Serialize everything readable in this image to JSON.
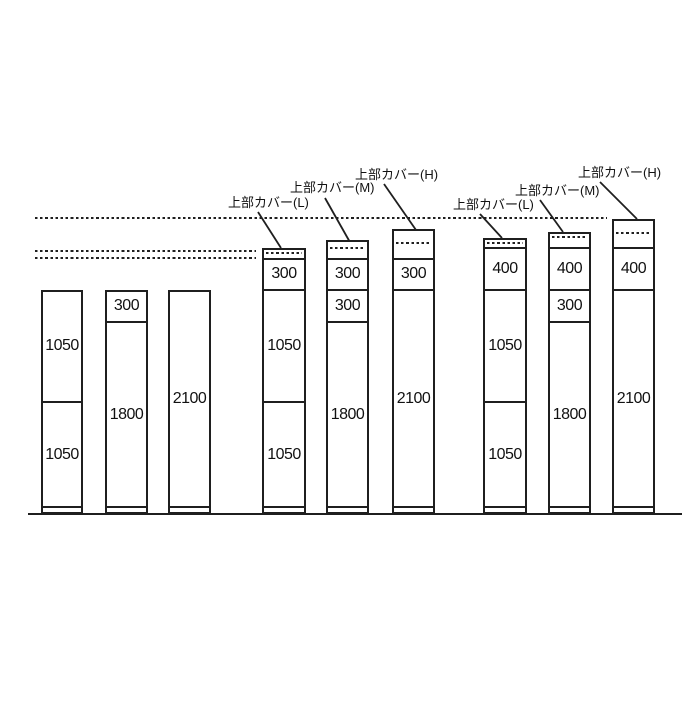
{
  "diagram": {
    "background": "#ffffff",
    "line_color": "#1f1f1f",
    "baseline": {
      "y": 514,
      "x1": 28,
      "x2": 682
    },
    "plinth_offset": 7,
    "guide_lines": [
      {
        "name": "ceiling-guide-line",
        "y": 218,
        "x1": 35,
        "x2": 607
      },
      {
        "name": "upper-ref-guide-line",
        "y": 251,
        "x1": 35,
        "x2": 256
      },
      {
        "name": "lower-ref-guide-line",
        "y": 258,
        "x1": 35,
        "x2": 256
      }
    ],
    "cover_labels": [
      {
        "text": "上部カバー(L)",
        "x": 228,
        "y": 195,
        "leader": [
          258,
          212,
          281,
          248
        ]
      },
      {
        "text": "上部カバー(M)",
        "x": 290,
        "y": 180,
        "leader": [
          325,
          198,
          351,
          244
        ]
      },
      {
        "text": "上部カバー(H)",
        "x": 355,
        "y": 167,
        "leader": [
          384,
          184,
          416,
          230
        ]
      },
      {
        "text": "上部カバー(L)",
        "x": 453,
        "y": 197,
        "leader": [
          480,
          214,
          502,
          238
        ]
      },
      {
        "text": "上部カバー(M)",
        "x": 515,
        "y": 183,
        "leader": [
          540,
          200,
          563,
          232
        ]
      },
      {
        "text": "上部カバー(H)",
        "x": 578,
        "y": 165,
        "leader": [
          600,
          182,
          637,
          219
        ]
      }
    ],
    "bars": [
      {
        "x": 41,
        "w": 42,
        "segments": [
          {
            "value": "1050",
            "h": 112
          },
          {
            "value": "1050",
            "h": 112
          }
        ]
      },
      {
        "x": 105,
        "w": 43,
        "segments": [
          {
            "value": "300",
            "h": 32
          },
          {
            "value": "1800",
            "h": 192
          }
        ]
      },
      {
        "x": 168,
        "w": 43,
        "segments": [
          {
            "value": "2100",
            "h": 224
          }
        ]
      },
      {
        "x": 262,
        "w": 44,
        "cover": {
          "type": "L",
          "h": 10,
          "dash": 5
        },
        "segments": [
          {
            "value": "300",
            "h": 32
          },
          {
            "value": "1050",
            "h": 112
          },
          {
            "value": "1050",
            "h": 112
          }
        ]
      },
      {
        "x": 326,
        "w": 43,
        "cover": {
          "type": "M",
          "h": 18,
          "dash": 8
        },
        "segments": [
          {
            "value": "300",
            "h": 32
          },
          {
            "value": "300",
            "h": 32
          },
          {
            "value": "1800",
            "h": 192
          }
        ]
      },
      {
        "x": 392,
        "w": 43,
        "cover": {
          "type": "H",
          "h": 29,
          "dash": 14
        },
        "segments": [
          {
            "value": "300",
            "h": 32
          },
          {
            "value": "2100",
            "h": 224
          }
        ]
      },
      {
        "x": 483,
        "w": 44,
        "cover": {
          "type": "L",
          "h": 9,
          "dash": 5
        },
        "segments": [
          {
            "value": "400",
            "h": 43
          },
          {
            "value": "1050",
            "h": 112
          },
          {
            "value": "1050",
            "h": 112
          }
        ]
      },
      {
        "x": 548,
        "w": 43,
        "cover": {
          "type": "M",
          "h": 15,
          "dash": 5
        },
        "segments": [
          {
            "value": "400",
            "h": 43
          },
          {
            "value": "300",
            "h": 32
          },
          {
            "value": "1800",
            "h": 192
          }
        ]
      },
      {
        "x": 612,
        "w": 43,
        "cover": {
          "type": "H",
          "h": 28,
          "dash": 14
        },
        "segments": [
          {
            "value": "400",
            "h": 43
          },
          {
            "value": "2100",
            "h": 224
          }
        ]
      }
    ]
  }
}
